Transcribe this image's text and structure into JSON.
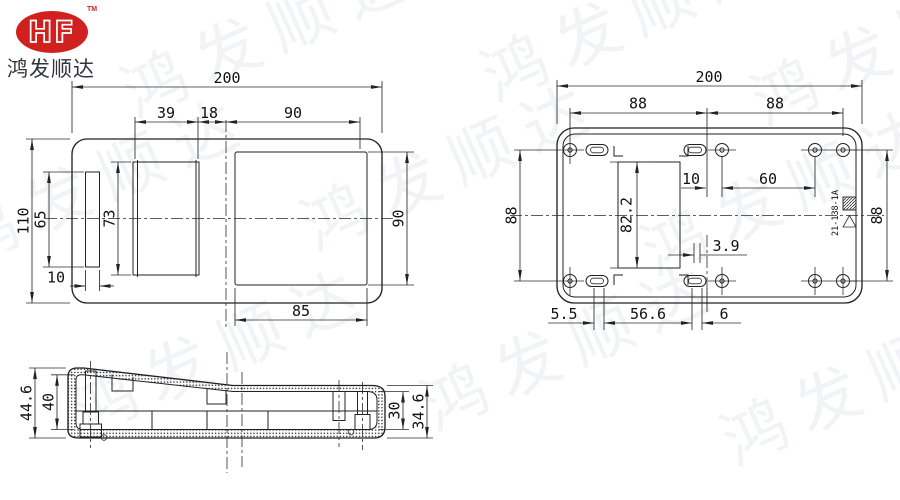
{
  "company": {
    "logo_text": "HF",
    "trademark": "TM",
    "name": "鸿发顺达",
    "logo_color": "#d0211f"
  },
  "watermark": {
    "text": "鸿发顺达"
  },
  "drawing": {
    "top_view": {
      "dim_overall_width": "200",
      "dim_left_rect_width": "39",
      "dim_gap": "18",
      "dim_opening_width": "90",
      "dim_overall_height": "110",
      "dim_slot_height": "65",
      "dim_rect_height": "73",
      "dim_slot_width": "10",
      "dim_opening_height": "90",
      "dim_opening_bottom_width": "85"
    },
    "bottom_view": {
      "dim_overall_width": "200",
      "dim_hole_pitch_left": "88",
      "dim_hole_pitch_right": "88",
      "dim_offset_10": "10",
      "dim_pitch_60": "60",
      "dim_height_left": "88",
      "dim_height_right": "88",
      "dim_window_height": "82.2",
      "dim_offset_3_9": "3.9",
      "dim_offset_5_5": "5.5",
      "dim_span_56_6": "56.6",
      "dim_offset_6": "6",
      "mold_number": "21-138-1A"
    },
    "side_view": {
      "dim_outer_height_left": "44.6",
      "dim_inner_height_left": "40",
      "dim_inner_height_right": "30",
      "dim_outer_height_right": "34.6"
    }
  }
}
